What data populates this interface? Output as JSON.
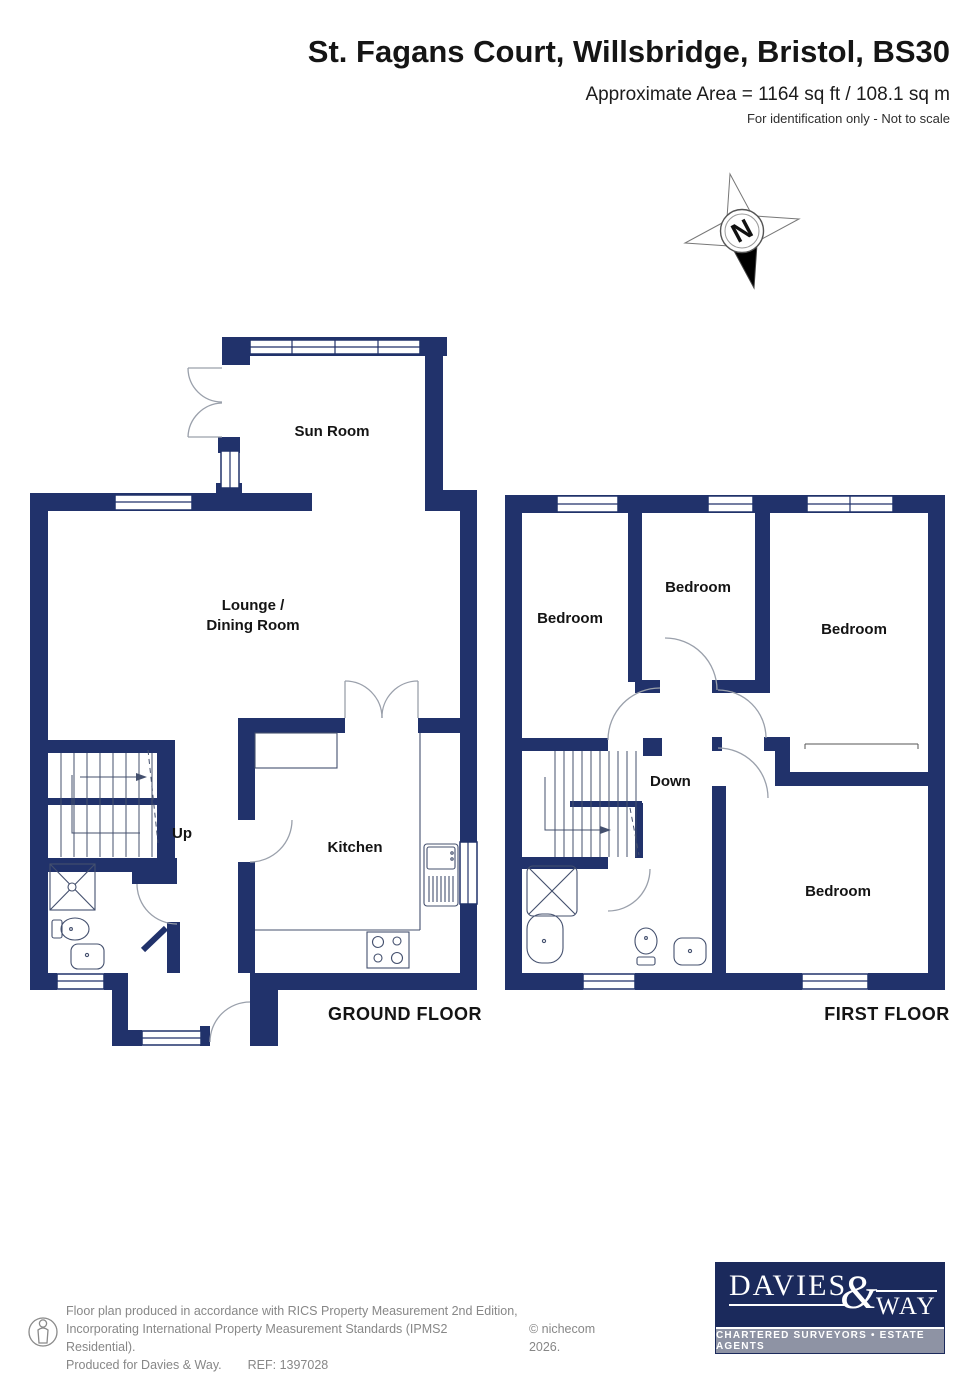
{
  "header": {
    "title": "St. Fagans Court, Willsbridge, Bristol, BS30",
    "area": "Approximate Area = 1164 sq ft / 108.1 sq m",
    "disclaimer": "For identification only - Not to scale"
  },
  "compass": {
    "label": "N"
  },
  "ground_floor": {
    "title": "GROUND FLOOR",
    "labels": {
      "sun_room": "Sun Room",
      "lounge_line1": "Lounge /",
      "lounge_line2": "Dining Room",
      "kitchen": "Kitchen",
      "stairs": "Up"
    },
    "fixtures": [
      "stairs-up",
      "shower-tray",
      "toilet",
      "basin",
      "kitchen-sink",
      "hob",
      "front-door",
      "porch"
    ]
  },
  "first_floor": {
    "title": "FIRST FLOOR",
    "labels": {
      "bedroom_back_left": "Bedroom",
      "bedroom_middle": "Bedroom",
      "bedroom_right": "Bedroom",
      "bedroom_front": "Bedroom",
      "stairs": "Down"
    },
    "fixtures": [
      "stairs-down",
      "shower-bath",
      "toilet",
      "basin"
    ]
  },
  "footer": {
    "line1": "Floor plan produced in accordance with RICS Property Measurement 2nd Edition,",
    "line2": "Incorporating International Property Measurement Standards (IPMS2 Residential).",
    "copyright": "© nichecom 2026.",
    "produced": "Produced for Davies & Way.",
    "ref": "REF:  1397028"
  },
  "logo": {
    "word1": "DAVIES",
    "amp": "&",
    "word2": "WAY",
    "tagline": "CHARTERED SURVEYORS • ESTATE AGENTS"
  },
  "colors": {
    "wall": "#21326b",
    "line": "#44506e",
    "arc": "#9aa0ab",
    "logo_navy": "#1b2a5c",
    "logo_gray": "#8e93a4",
    "muted": "#878787"
  }
}
